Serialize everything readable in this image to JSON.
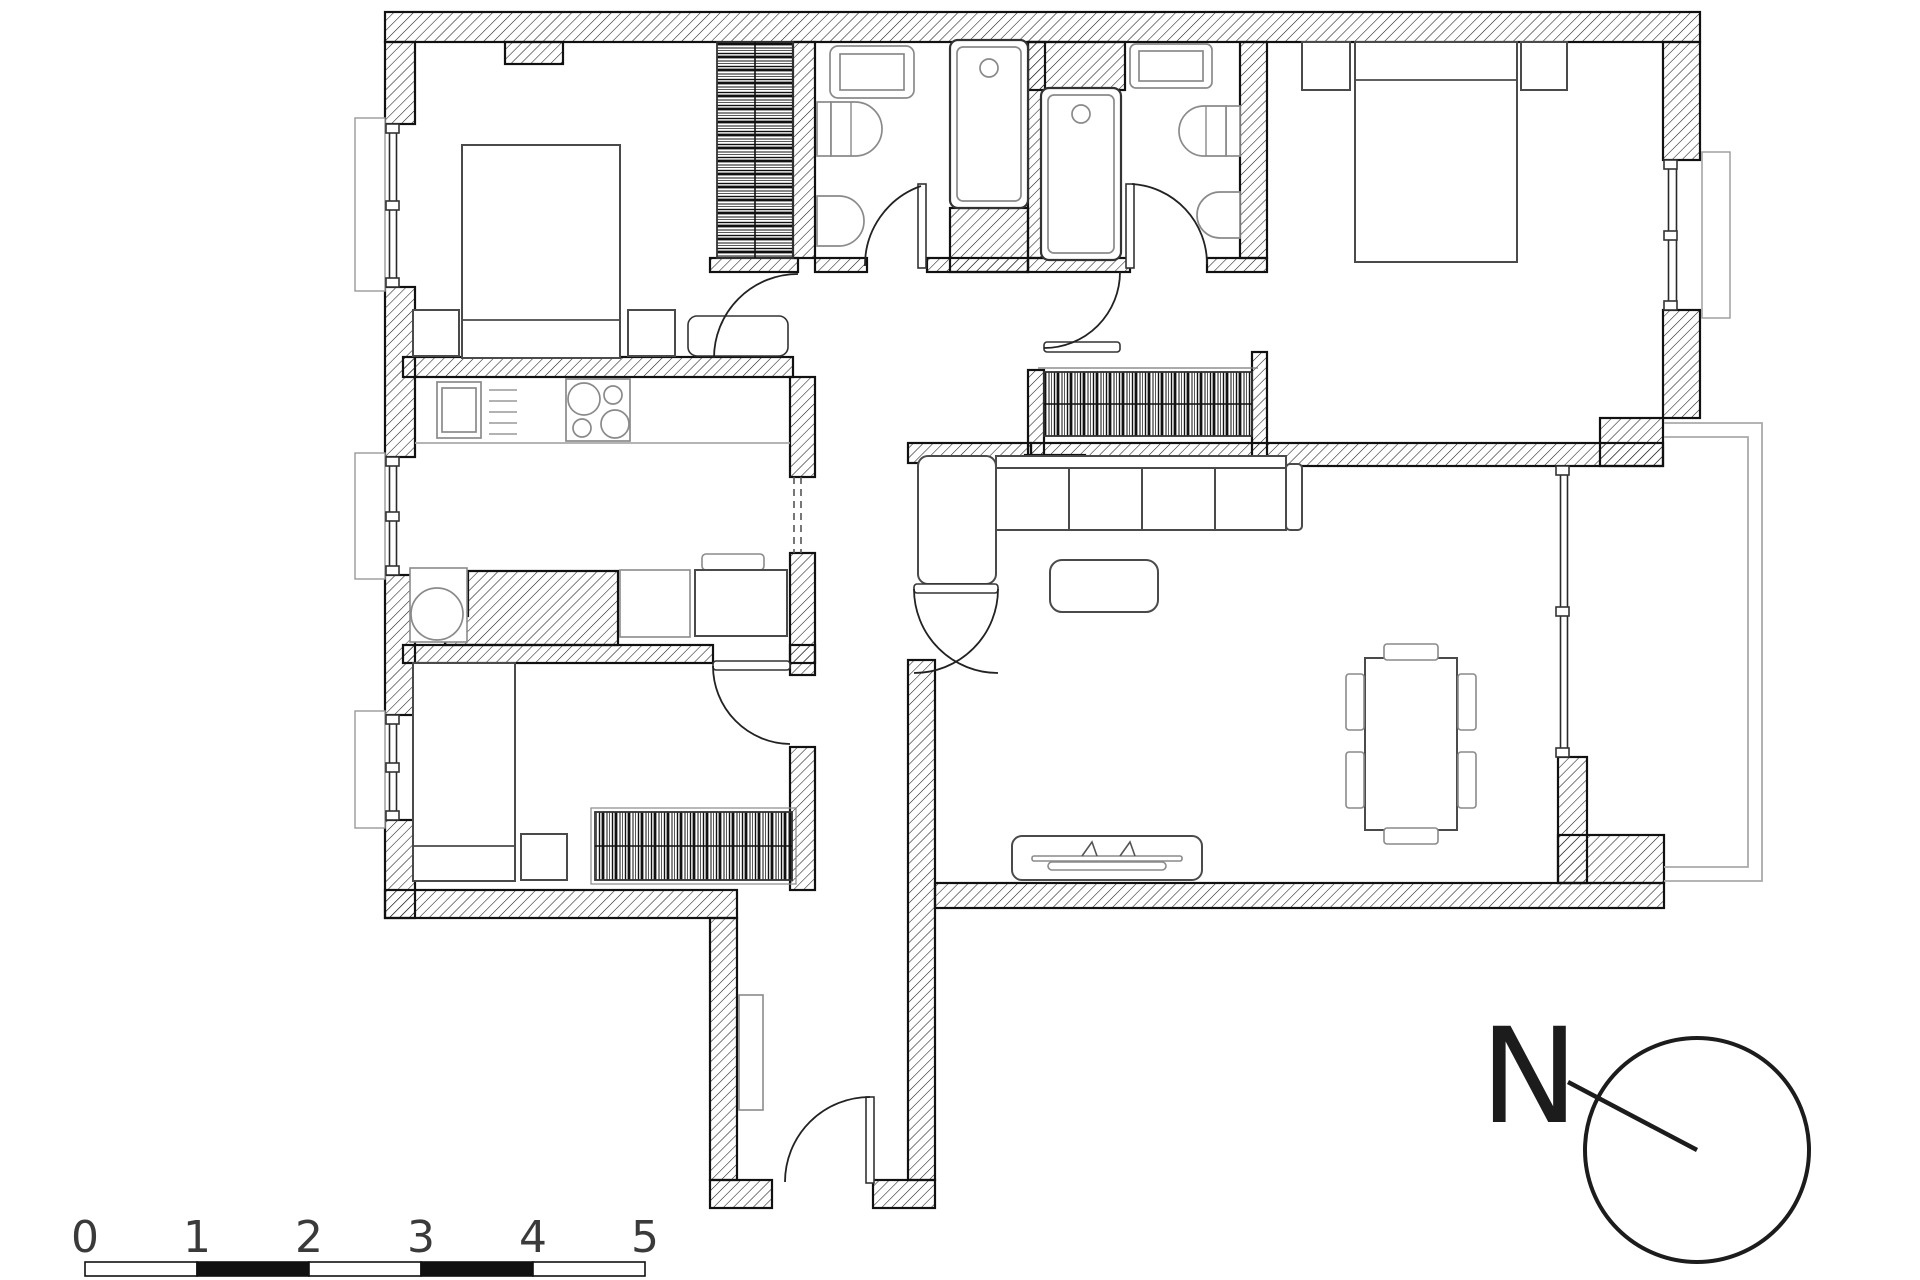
{
  "drawing": {
    "type": "apartment-floor-plan",
    "background": "#ffffff",
    "wall_line_color": "#111111",
    "hatch_color": "#1a1a1a",
    "furniture_line_color": "#4a4a4a",
    "fixture_line_color": "#8a8a8a"
  },
  "scale_bar": {
    "labels": [
      "0",
      "1",
      "2",
      "3",
      "4",
      "5"
    ],
    "segment_fills": [
      "#ffffff",
      "#111111",
      "#ffffff",
      "#111111",
      "#ffffff"
    ],
    "outline_color": "#111111"
  },
  "north_indicator": {
    "label": "N"
  },
  "rooms": [
    {
      "name": "bedroom-top-left"
    },
    {
      "name": "bathroom-1"
    },
    {
      "name": "bathroom-2"
    },
    {
      "name": "bedroom-top-right"
    },
    {
      "name": "kitchen"
    },
    {
      "name": "bedroom-bottom-left"
    },
    {
      "name": "living-dining-room"
    },
    {
      "name": "hallway"
    },
    {
      "name": "entrance-corridor"
    },
    {
      "name": "balcony"
    }
  ],
  "furniture_icons": [
    "double-bed-icon",
    "single-bed-icon",
    "nightstand-icon",
    "wardrobe-icon",
    "bathtub-icon",
    "washbasin-icon",
    "toilet-icon",
    "bidet-icon",
    "kitchen-sink-icon",
    "cooktop-icon",
    "washing-machine-icon",
    "desk-icon",
    "corner-sofa-icon",
    "coffee-table-icon",
    "tv-console-icon",
    "dining-table-icon",
    "chair-icon",
    "radiator-icon",
    "door-swing-icon",
    "window-icon",
    "scale-bar-icon",
    "north-arrow-icon"
  ]
}
